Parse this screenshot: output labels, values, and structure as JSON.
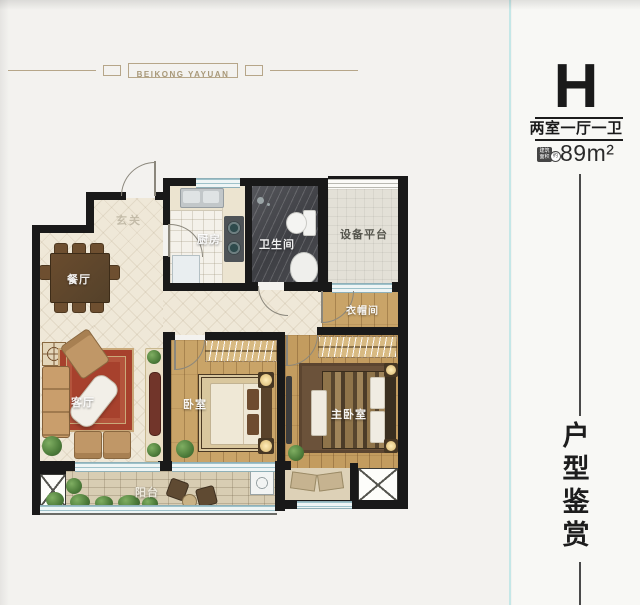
{
  "header": {
    "brand": "BEIKONG YAYUAN"
  },
  "panel": {
    "unit_letter": "H",
    "unit_layout": "两室一厅一卫",
    "area_badge": "建筑面积",
    "area_badge_circle": "约",
    "area": "89m²",
    "vertical_title": [
      "户",
      "型",
      "鉴",
      "赏"
    ]
  },
  "plan": {
    "labels": {
      "entrance": "玄关",
      "dining": "餐厅",
      "kitchen": "厨房",
      "bathroom": "卫生间",
      "equipment_platform": "设备平台",
      "cloakroom": "衣帽间",
      "living": "客厅",
      "bedroom": "卧室",
      "master_bedroom": "主卧室",
      "balcony": "阳台"
    }
  },
  "colors": {
    "accent_gold": "#b6a689",
    "wall_black": "#191919",
    "window_blue": "#9dc2ca",
    "divider_cyan": "#c4e7e7",
    "living_rug_red": "#a7412d"
  }
}
